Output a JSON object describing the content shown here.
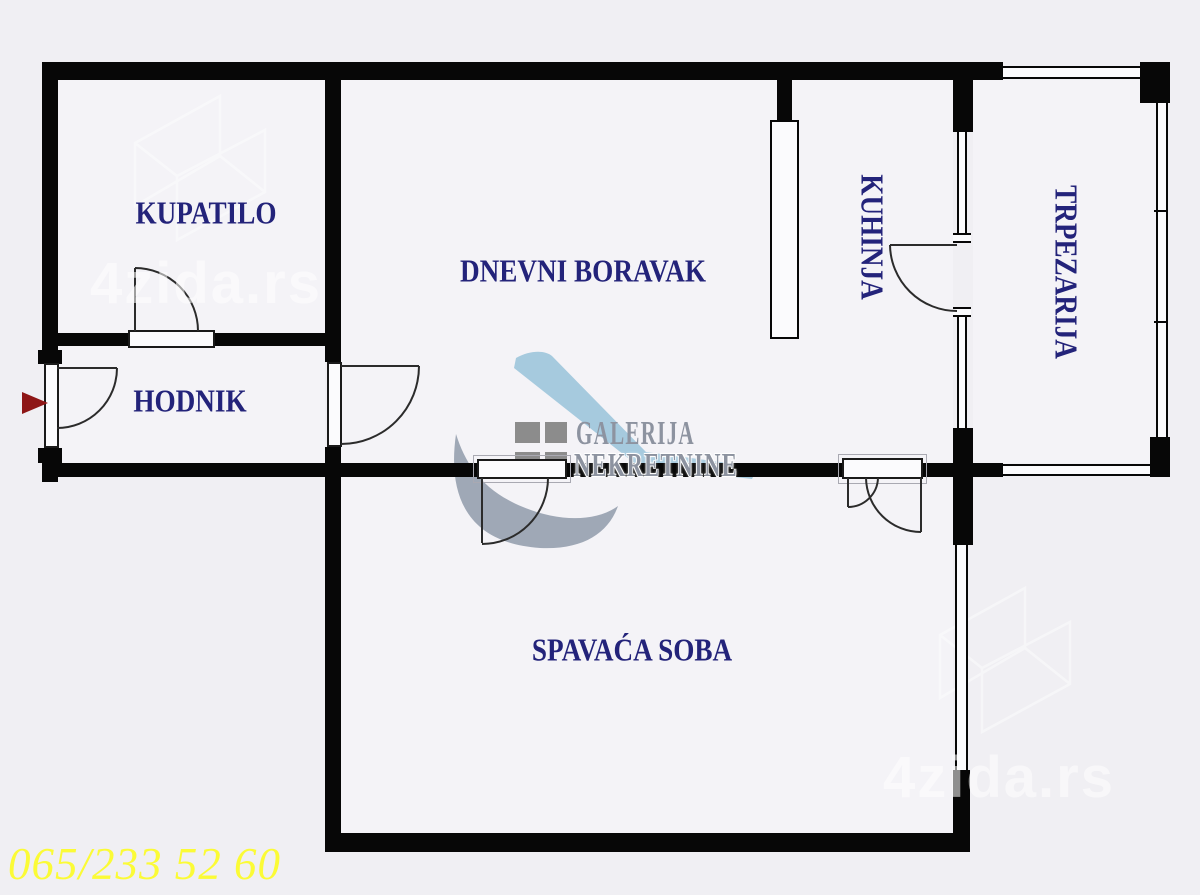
{
  "rooms": {
    "bathroom": "KUPATILO",
    "living_room": "DNEVNI BORAVAK",
    "kitchen": "KUHINJA",
    "dining_room": "TRPEZARIJA",
    "hallway": "HODNIK",
    "bedroom": "SPAVAĆA SOBA"
  },
  "branding": {
    "agency_name_line1": "GALERIJA",
    "agency_name_line2": "NEKRETNINE",
    "watermark": "4zida.rs"
  },
  "contact": {
    "phone_number": "065/233 52 60"
  },
  "colors": {
    "background": "#f0eff3",
    "room_fill": "#f4f3f7",
    "wall": "#070707",
    "door_stroke": "#2b2b2b",
    "room_label": "#23237a",
    "logo_text": "#8d93a0",
    "logo_blue": "#a6cade",
    "logo_square": "#8c8c8c",
    "logo_crescent": "#9aa3b2",
    "phone": "#fbfb36",
    "entry_arrow": "#8e1616",
    "watermark": "#ffffff"
  }
}
